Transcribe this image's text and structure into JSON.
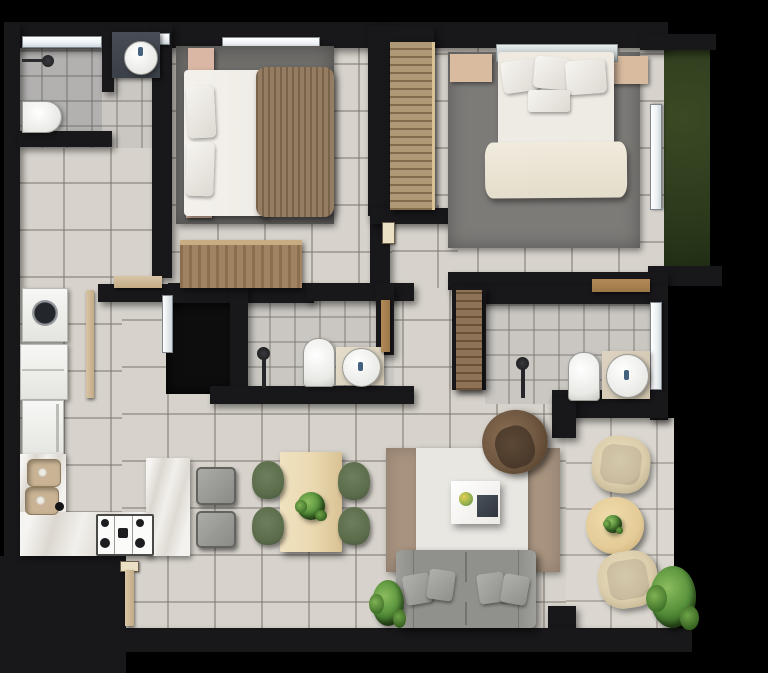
{
  "meta": {
    "type": "floor-plan",
    "description": "Top-down 3D rendered floor plan of a two-bedroom apartment with two bathrooms, kitchen, dining and living area, side terrace and a grass planter strip",
    "visible_text": "none",
    "canvas": {
      "width_px": 768,
      "height_px": 673
    }
  },
  "colors": {
    "background": "#000000",
    "wall": "#18171a",
    "tile": "#d7d3cc",
    "bathTile": "#cac7c2",
    "terraceTile": "#dbd7d0",
    "grass": "#2c3a1c",
    "rugBedroom1": "#6f6e6b",
    "rugMaster": "#7d7b78",
    "rugTaupe": "#a8937f",
    "rugWhite": "#e9e7e2",
    "marble": "#ebe8e2",
    "woodLight": "#a8906c",
    "woodDark": "#85684a",
    "nightstandPink": "#dab7a4",
    "nightstandBeige": "#d9bb9f",
    "blanketBrown": "#8d7357",
    "bedding": "#efece6",
    "sofaGray": "#90908c",
    "armchairBrown": "#6e5640",
    "armchairSeat": "#4b3a2b",
    "chairGreen": "#5c6d4c",
    "terraceChair": "#dcceac",
    "terraceCushion": "#c8bb9e",
    "diningTable": "#ead8b0",
    "roundTable": "#e4cb97",
    "plantGreen": "#57923b",
    "doorTan": "#d8c5a6",
    "doorWood": "#b28a58",
    "windowWhite": "#eef2f4",
    "fixtureWhite": "#fbfbf9",
    "darkCounter": "#3b3f47",
    "closetDark": "#0d0d0e"
  },
  "rooms": [
    {
      "name": "bathroom-top-left",
      "furniture": [
        "two windows",
        "dark vanity with round basin sink",
        "wall shower",
        "toilet",
        "partition wall"
      ]
    },
    {
      "name": "laundry-service-area",
      "furniture": [
        "washing machine with glass door",
        "white appliance",
        "refrigerator",
        "service door"
      ]
    },
    {
      "name": "kitchen",
      "furniture": [
        "L-shaped marble counter",
        "double basin sink",
        "gas cooktop with burners",
        "two gray bar stools"
      ]
    },
    {
      "name": "bedroom-1",
      "furniture": [
        "window",
        "double bed with white bedding and brown blanket",
        "two pink nightstands",
        "dark gray area rug",
        "wood dresser",
        "entry door"
      ]
    },
    {
      "name": "master-bedroom",
      "furniture": [
        "glass headboard",
        "double bed with cream bedding",
        "two beige nightstands",
        "gray area rug",
        "built-in wood wardrobe",
        "side window",
        "wood entry door"
      ]
    },
    {
      "name": "bathroom-middle",
      "furniture": [
        "dark walk-in closet",
        "shower column",
        "toilet",
        "round basin sink on counter",
        "wood door"
      ]
    },
    {
      "name": "ensuite-bathroom",
      "furniture": [
        "tall wood cabinet",
        "shower column",
        "toilet",
        "round basin sink on counter",
        "side window"
      ]
    },
    {
      "name": "dining-area",
      "furniture": [
        "light wood rectangular table",
        "four green chairs",
        "green centerpiece plant"
      ]
    },
    {
      "name": "living-room",
      "furniture": [
        "taupe rug",
        "layered white rug",
        "white coffee table with flowers and dark tray",
        "round brown swivel armchair",
        "gray two-seat sofa with four pillows",
        "floor plant",
        "entrance door"
      ]
    },
    {
      "name": "terrace",
      "furniture": [
        "two beige lounge chairs",
        "round wood side table with small plant",
        "large potted plant"
      ]
    },
    {
      "name": "exterior",
      "furniture": [
        "grass planter strip"
      ]
    }
  ]
}
